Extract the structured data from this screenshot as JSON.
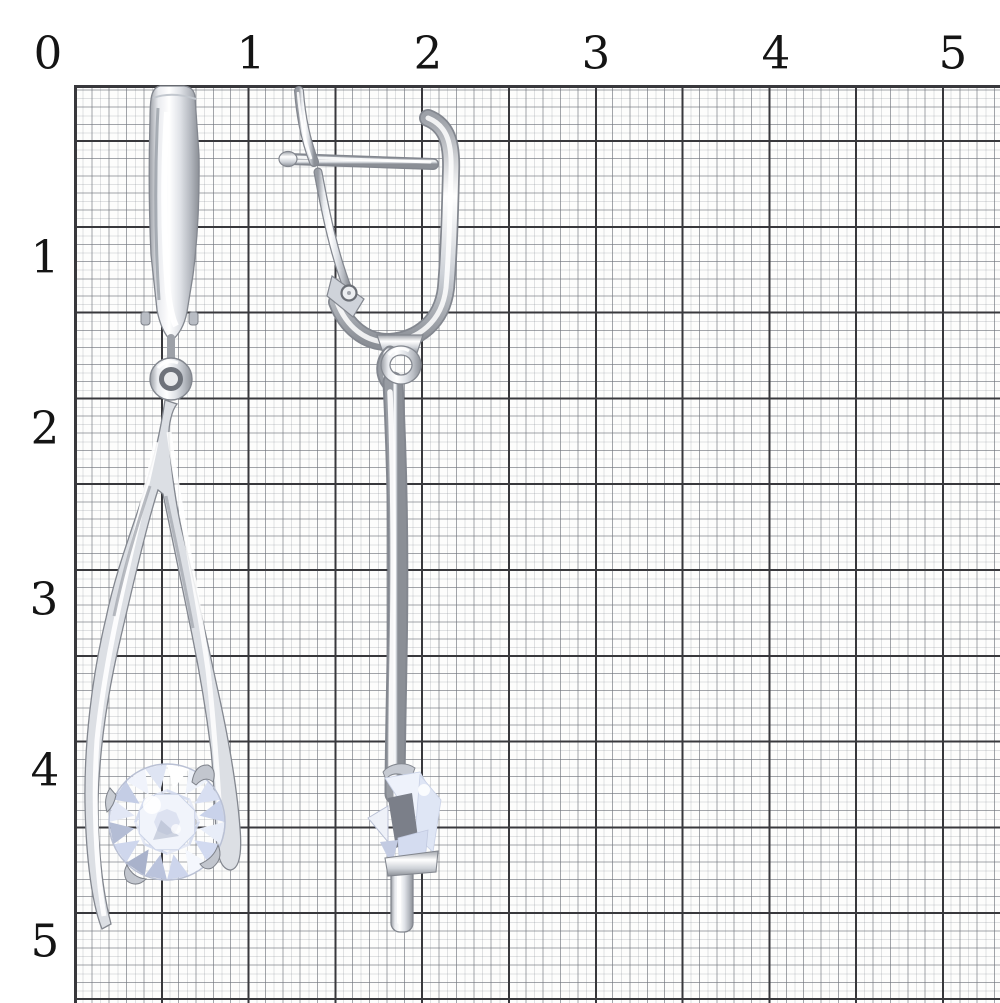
{
  "scene": {
    "left_object": "silver drop earring, front view, english lock, split wishbone drop, round cubic zirconia stone",
    "right_object": "silver drop earring, side view, english lock profile, long bar drop, cubic zirconia seen edge-on"
  },
  "ruler": {
    "top_labels": [
      "0",
      "1",
      "2",
      "3",
      "4",
      "5"
    ],
    "left_labels": [
      "1",
      "2",
      "3",
      "4",
      "5"
    ]
  },
  "colors": {
    "paper": "#fdfdfc",
    "grid_minor": "#9aa0a6",
    "grid_major": "#38383c",
    "label": "#141414",
    "metal_light": "#ffffff",
    "metal_mid": "#c7cbd1",
    "metal_dark": "#84888f",
    "stone_tint": "#dfe5f4"
  }
}
